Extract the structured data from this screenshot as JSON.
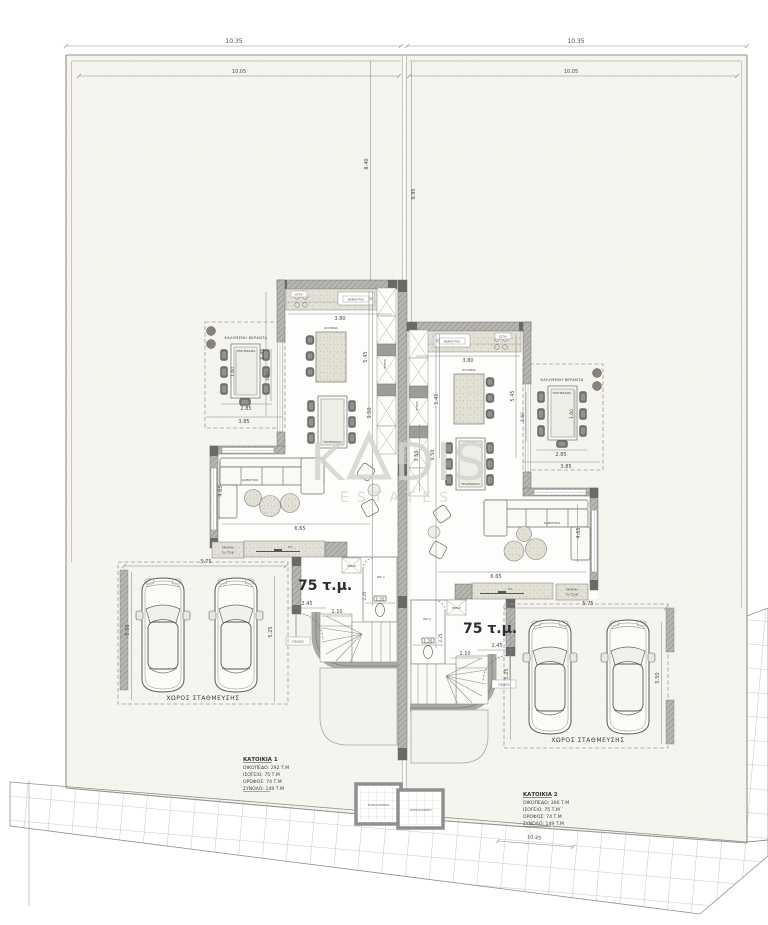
{
  "watermark": {
    "brand": "KADIS",
    "part1": "K",
    "part2": "DIS",
    "tagline": "ESTATES"
  },
  "site": {
    "dims": {
      "width_left_outer": "10.35",
      "width_right_outer": "10.35",
      "width_left_inner": "10.05",
      "width_right_inner": "10.05",
      "depth_left": "8.40",
      "depth_right": "9.95",
      "street_bottom": "10.45"
    }
  },
  "units": {
    "left": {
      "area": "75 τ.μ.",
      "rooms": {
        "kitchen": "ΚΟΥΖΙΝΑ",
        "dining": "ΤΡΑΠΕΖΑΡΙΑ",
        "living": "ΚΑΘΙΣΤΙΚΟ",
        "veranda": "ΚΑΛΥΜΕΝΗ ΒΕΡΑΝΤΑ",
        "veranda_dining": "ΤΡΑΠΕΖΑΡΙΑ",
        "wc": "WC 1",
        "entrance": "ΕΙΣΟΔΟΣ",
        "parking": "ΧΩΡΟΣ ΣΤΑΘΜΕΥΣΗΣ"
      },
      "fixtures": {
        "tv": "TV",
        "fireplace_line1": "ΠΡΟΝΟΙΑ",
        "fireplace_line2": "ΓΙΑ ΤΖΑΚΙ",
        "sink": "ΝΕΡΟΧΥΤΗΣ",
        "stove": "ΕΣΤΙΑ",
        "fridge": "ΨΥΓΕΙΟ",
        "closet": "ΕΡΜΑΡΙ"
      },
      "dims": {
        "kitchen_width": "3.80",
        "kitchen_depth": "5.45",
        "veranda_depth": "5.45",
        "veranda_table_width": "1.60",
        "veranda_table_length": "3.60",
        "veranda_width_inner": "2.85",
        "veranda_width": "3.85",
        "unit_depth": "9.50",
        "living_width": "6.65",
        "living_depth": "4.65",
        "hall": "2.45",
        "stair": "1.10",
        "wc_width": "1.25",
        "wc_depth": "2.25",
        "parking_width": "5.75",
        "parking_depth_left": "5.50",
        "parking_depth_right": "5.25"
      }
    },
    "right": {
      "area": "75 τ.μ.",
      "rooms": {
        "kitchen": "ΚΟΥΖΙΝΑ",
        "dining": "ΤΡΑΠΕΖΑΡΙΑ",
        "living": "ΚΑΘΙΣΤΙΚΟ",
        "veranda": "ΚΑΛΥΜΕΝΗ ΒΕΡΑΝΤΑ",
        "veranda_dining": "ΤΡΑΠΕΖΑΡΙΑ",
        "wc": "WC 1",
        "entrance": "ΕΙΣΟΔΟΣ",
        "parking": "ΧΩΡΟΣ ΣΤΑΘΜΕΥΣΗΣ"
      },
      "fixtures": {
        "tv": "TV",
        "fireplace_line1": "ΠΡΟΝΟΙΑ",
        "fireplace_line2": "ΓΙΑ ΤΖΑΚΙ",
        "sink": "ΝΕΡΟΧΥΤΗΣ",
        "stove": "ΕΣΤΙΑ",
        "fridge": "ΨΥΓΕΙΟ",
        "closet": "ΕΡΜΑΡΙ"
      },
      "dims": {
        "kitchen_width": "3.80",
        "kitchen_depth": "5.45",
        "veranda_depth": "5.45",
        "veranda_table_width": "1.60",
        "veranda_table_length": "3.60",
        "veranda_width_inner": "2.85",
        "veranda_width": "3.85",
        "unit_depth": "9.50",
        "living_width": "6.65",
        "living_depth": "4.65",
        "cabinet": "3.50",
        "hall": "2.45",
        "stair": "1.10",
        "wc_width": "1.25",
        "wc_depth": "2.25",
        "parking_width": "5.75",
        "parking_depth_left": "5.25",
        "parking_depth_right": "5.50"
      }
    }
  },
  "info": {
    "house1": {
      "title": "ΚΑΤΟΙΚΙΑ 1",
      "line1": "ΟΙΚΟΠΕΔΟ: 292 Τ.Μ",
      "line2": "ΙΣΟΓΕΙΟ: 75 Τ.Μ",
      "line3": "ΟΡΟΦΟΣ: 74 Τ.Μ",
      "line4": "ΣΥΝΟΛΟ: 149 Τ.Μ"
    },
    "house2": {
      "title": "ΚΑΤΟΙΚΙΑ 2",
      "line1": "ΟΙΚΟΠΕΔΟ: 306 Τ.Μ",
      "line2": "ΙΣΟΓΕΙΟ: 75 Τ.Μ",
      "line3": "ΟΡΟΦΟΣ: 74 Τ.Μ",
      "line4": "ΣΥΝΟΛΟ: 149 Τ.Μ"
    }
  },
  "bins": {
    "label": "ΣΚΥΒΑΛΑΠΟΘΗΚΗ"
  },
  "colors": {
    "plot_fill": "#f5f4ee",
    "wall": "#b2b1ad",
    "wall_dark": "#696967",
    "watermark": "#d4d3cf",
    "dim_text": "#4a4a4a"
  }
}
